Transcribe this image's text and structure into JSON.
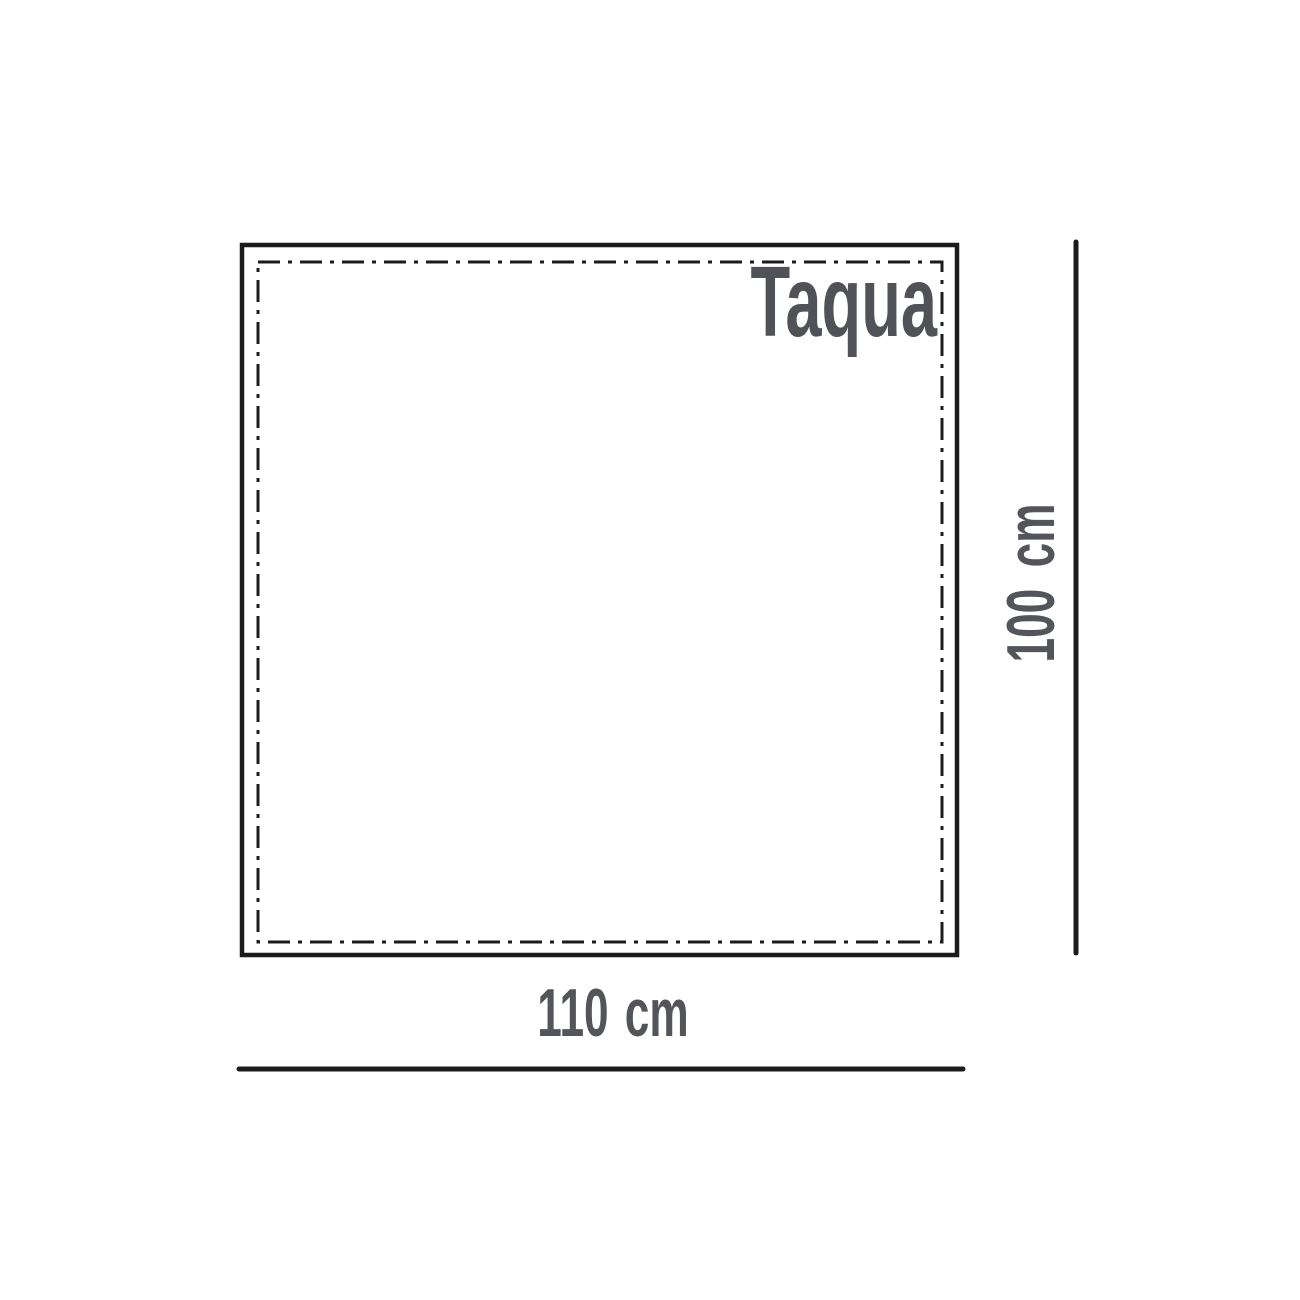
{
  "diagram": {
    "brand_label": "Taqua",
    "width_label": "110 cm",
    "height_label": "100 cm"
  },
  "colors": {
    "outline": "#1c1c1c",
    "label_gray": "#53555a",
    "brand_gray": "#505257",
    "background": "#ffffff"
  }
}
